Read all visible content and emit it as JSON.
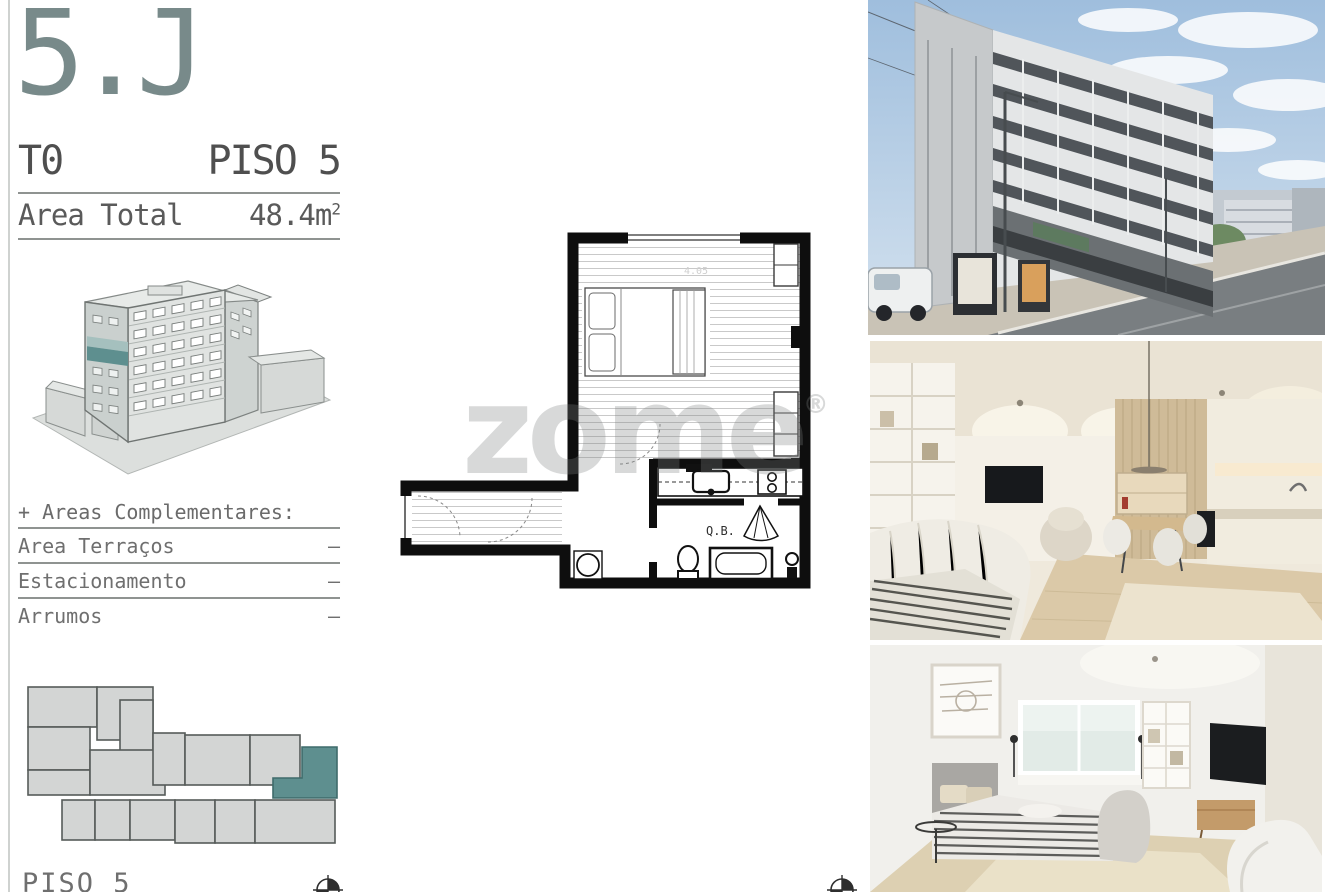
{
  "accent_color": "#5e8f8f",
  "unit": {
    "code": "5.J",
    "typology": "T0",
    "floor": "PISO 5",
    "area_label": "Area Total",
    "area_value": "48.4m",
    "area_exponent": "2"
  },
  "complementary": {
    "heading": "+ Areas Complementares:",
    "rows": [
      {
        "label": "Area Terraços",
        "value": "–"
      },
      {
        "label": "Estacionamento",
        "value": "–"
      },
      {
        "label": "Arrumos",
        "value": "–"
      }
    ]
  },
  "key_plan": {
    "caption": "PISO 5"
  },
  "floor_plan": {
    "bathroom_label": "Q.B.",
    "dimension_label": "4.05"
  },
  "watermark": {
    "text": "zome",
    "registered": "®"
  },
  "photos": [
    {
      "name": "building-exterior-street-view"
    },
    {
      "name": "living-room-kitchen-render"
    },
    {
      "name": "bedroom-render"
    }
  ]
}
